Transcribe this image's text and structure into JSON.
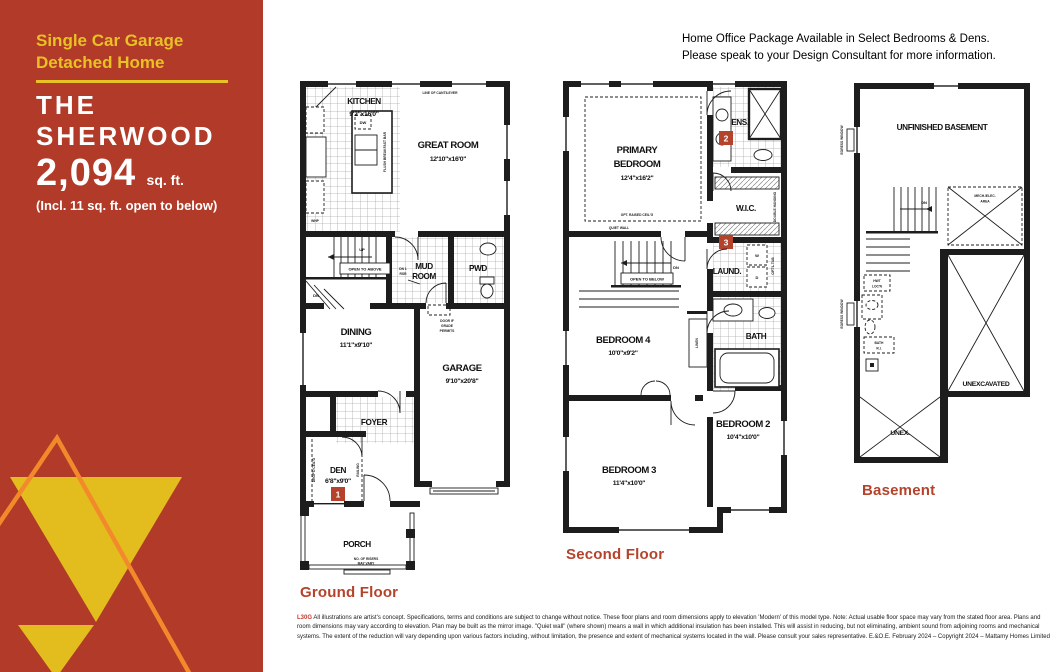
{
  "sidebar": {
    "tagline1": "Single Car Garage",
    "tagline2": "Detached Home",
    "title1": "THE",
    "title2": "SHERWOOD",
    "area": "2,094",
    "area_unit": "sq. ft.",
    "area_note": "(Incl. 11 sq. ft. open to below)"
  },
  "header": {
    "line1": "Home Office Package Available in Select Bedrooms & Dens.",
    "line2": "Please speak to your Design Consultant for more information."
  },
  "ground": {
    "label": "Ground Floor",
    "kitchen": "KITCHEN",
    "kitchen_dims": "9'2\"x16'0\"",
    "great_room": "GREAT ROOM",
    "great_room_dims": "12'10\"x16'0\"",
    "dining": "DINING",
    "dining_dims": "11'1\"x9'10\"",
    "garage": "GARAGE",
    "garage_dims": "9'10\"x20'8\"",
    "mud1": "MUD",
    "mud2": "ROOM",
    "pwd": "PWD",
    "foyer": "FOYER",
    "den": "DEN",
    "den_dims": "6'8\"x9'0\"",
    "den_badge": "1",
    "porch": "PORCH",
    "dw": "DW",
    "flush_bar": "FLUSH BREAKFAST BAR",
    "open_to_above": "OPEN TO ABOVE",
    "up": "UP",
    "dn": "DN",
    "dn_rsr1": "DN 1",
    "dn_rsr2": "RSR",
    "door_grade1": "DOOR IF",
    "door_grade2": "GRADE",
    "door_grade3": "PERMITS",
    "cantilever": "LINE OF CANTILEVER",
    "whp": "WHP",
    "dropd_ceiling": "DROP'D CEIL'G",
    "railing": "RAILING",
    "risers1": "NO. OF RISERS",
    "risers2": "MAY VARY"
  },
  "second": {
    "label": "Second Floor",
    "primary1": "PRIMARY",
    "primary2": "BEDROOM",
    "primary_dims": "12'4\"x16'2\"",
    "raised_ceiling": "OPT. RAISED CEIL'G",
    "quiet_wall": "QUIET WALL",
    "ens": "ENS.",
    "ens_badge": "2",
    "wic": "W.I.C.",
    "double_hanging": "DOUBLE HANGING",
    "laund": "LAUND.",
    "laund_badge": "3",
    "washer": "W",
    "dryer": "D",
    "optl_tub": "OPT'L TUB",
    "bath": "BATH",
    "linen": "LINEN",
    "bed4": "BEDROOM 4",
    "bed4_dims": "10'0\"x9'2\"",
    "bed3": "BEDROOM 3",
    "bed3_dims": "11'4\"x10'0\"",
    "bed2": "BEDROOM 2",
    "bed2_dims": "10'4\"x10'0\"",
    "open_to_below": "OPEN TO BELOW",
    "dn": "DN"
  },
  "basement": {
    "label": "Basement",
    "unfinished": "UNFINISHED BASEMENT",
    "unexcavated": "UNEXCAVATED",
    "unex": "UNEX.",
    "mech1": "MECH./ELEC.",
    "mech2": "AREA",
    "dn": "DN",
    "hwt1": "HWT",
    "hwt2": "LOC'N",
    "bath1": "BATH",
    "bath2": "R.I.",
    "egress": "EGRESS WINDOW"
  },
  "footer": {
    "code": "L30G",
    "text": "All illustrations are artist's concept. Specifications, terms and conditions are subject to change without notice. These floor plans and room dimensions apply to elevation 'Modern' of this model type. Note: Actual usable floor space may vary from the stated floor area. Plans and room dimensions may vary according to elevation. Plan may be built as the mirror image. \"Quiet wall\" (where shown) means a wall in which additional insulation has been installed. This will assist in reducing, but not eliminating, ambient sound from adjoining rooms and mechanical systems. The extent of the reduction will vary depending upon various factors including, without limitation, the presence and extent of mechanical systems located in the wall. Please consult your sales representative. E.&O.E. February 2024 – Copyright 2024 – Mattamy Homes Limited"
  }
}
